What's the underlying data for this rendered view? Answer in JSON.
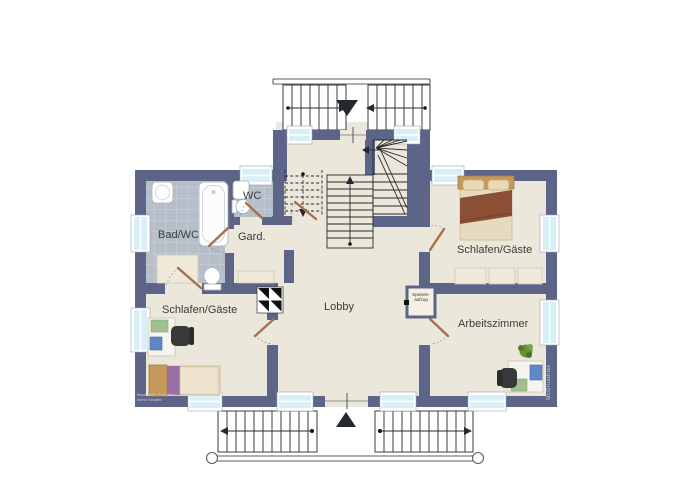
{
  "rooms": {
    "bad_wc": "Bad/WC",
    "wc": "WC",
    "gard": "Gard.",
    "schlafen_left": "Schlafen/Gäste",
    "schlafen_right": "Schlafen/Gäste",
    "lobby": "Lobby",
    "arbeitszimmer": "Arbeitszimmer"
  },
  "annotations": {
    "dumbwaiter_line1": "Speisen-",
    "dumbwaiter_line2": "aufzug",
    "watermark": "McGrundriss",
    "disclaimer_line1": "Illustrativer Grundriss",
    "disclaimer_line2": "keine Gewähr"
  },
  "colors": {
    "wall": "#5c6488",
    "floor": "#ece7db",
    "tile": "#b6bfc9",
    "tile_grout": "#ccd4db",
    "window_glass": "#d9eff8",
    "window_frame": "#ffffff",
    "door_leaf": "#a5714a",
    "stair_line": "#2a2a2a",
    "label": "#3b3b3b",
    "furniture_light": "#efe9da",
    "bed_wood": "#c49a5a",
    "bed_blanket": "#8a4f35",
    "bed_purple": "#9a6fa5",
    "chair_dark": "#383838",
    "plant_green": "#6b8f3a",
    "item_blue": "#5f87c5",
    "item_green": "#9fbf8f",
    "watermark": "#c7cede"
  }
}
